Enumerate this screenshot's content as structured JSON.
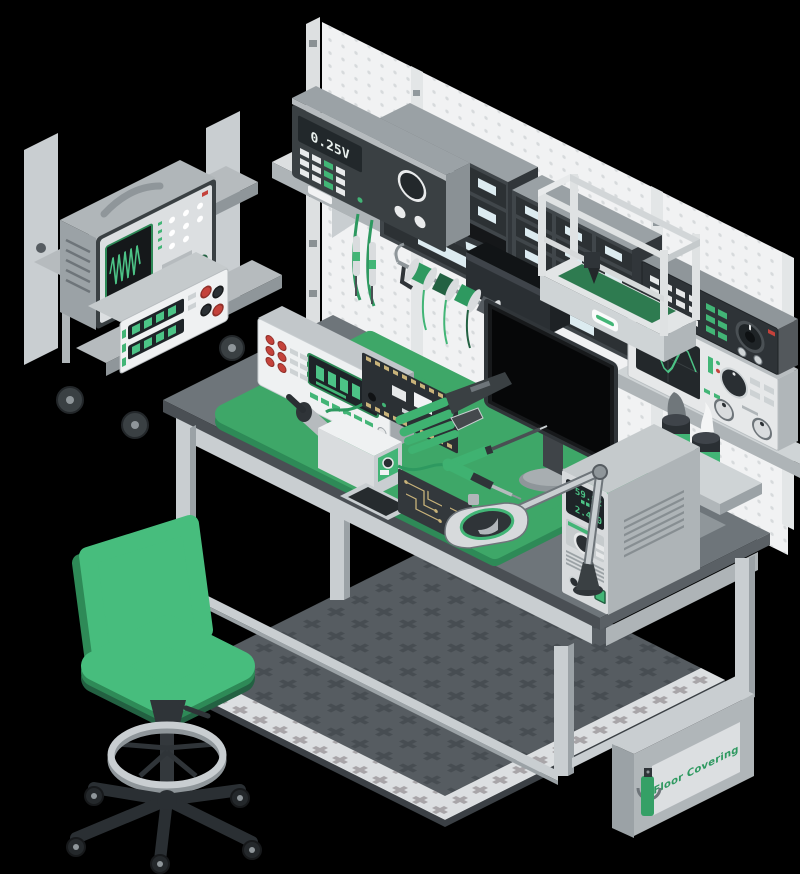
{
  "colors": {
    "green": "#42B576",
    "green_mid": "#2E9960",
    "green_dark": "#2E8A57",
    "green_deep": "#236142",
    "digit_green": "#4CC386",
    "red": "#C4423B",
    "gold": "#C9B37A",
    "pegboard": "#F1F2F3",
    "pegboard_dot": "#D7DADC",
    "floor_mat": "#565C61",
    "floor_mat_plus": "#474D52",
    "floor_border": "#DCDFE1",
    "floor_border_plus": "#A8A5A8",
    "desk_top": "#6E757A",
    "background": "#000000"
  },
  "labels": {
    "shelf_psu_display": "0.25V",
    "bench_psu_voltage": "59.82",
    "bench_psu_current": "2.460",
    "floor_box_label": "Floor Covering"
  }
}
